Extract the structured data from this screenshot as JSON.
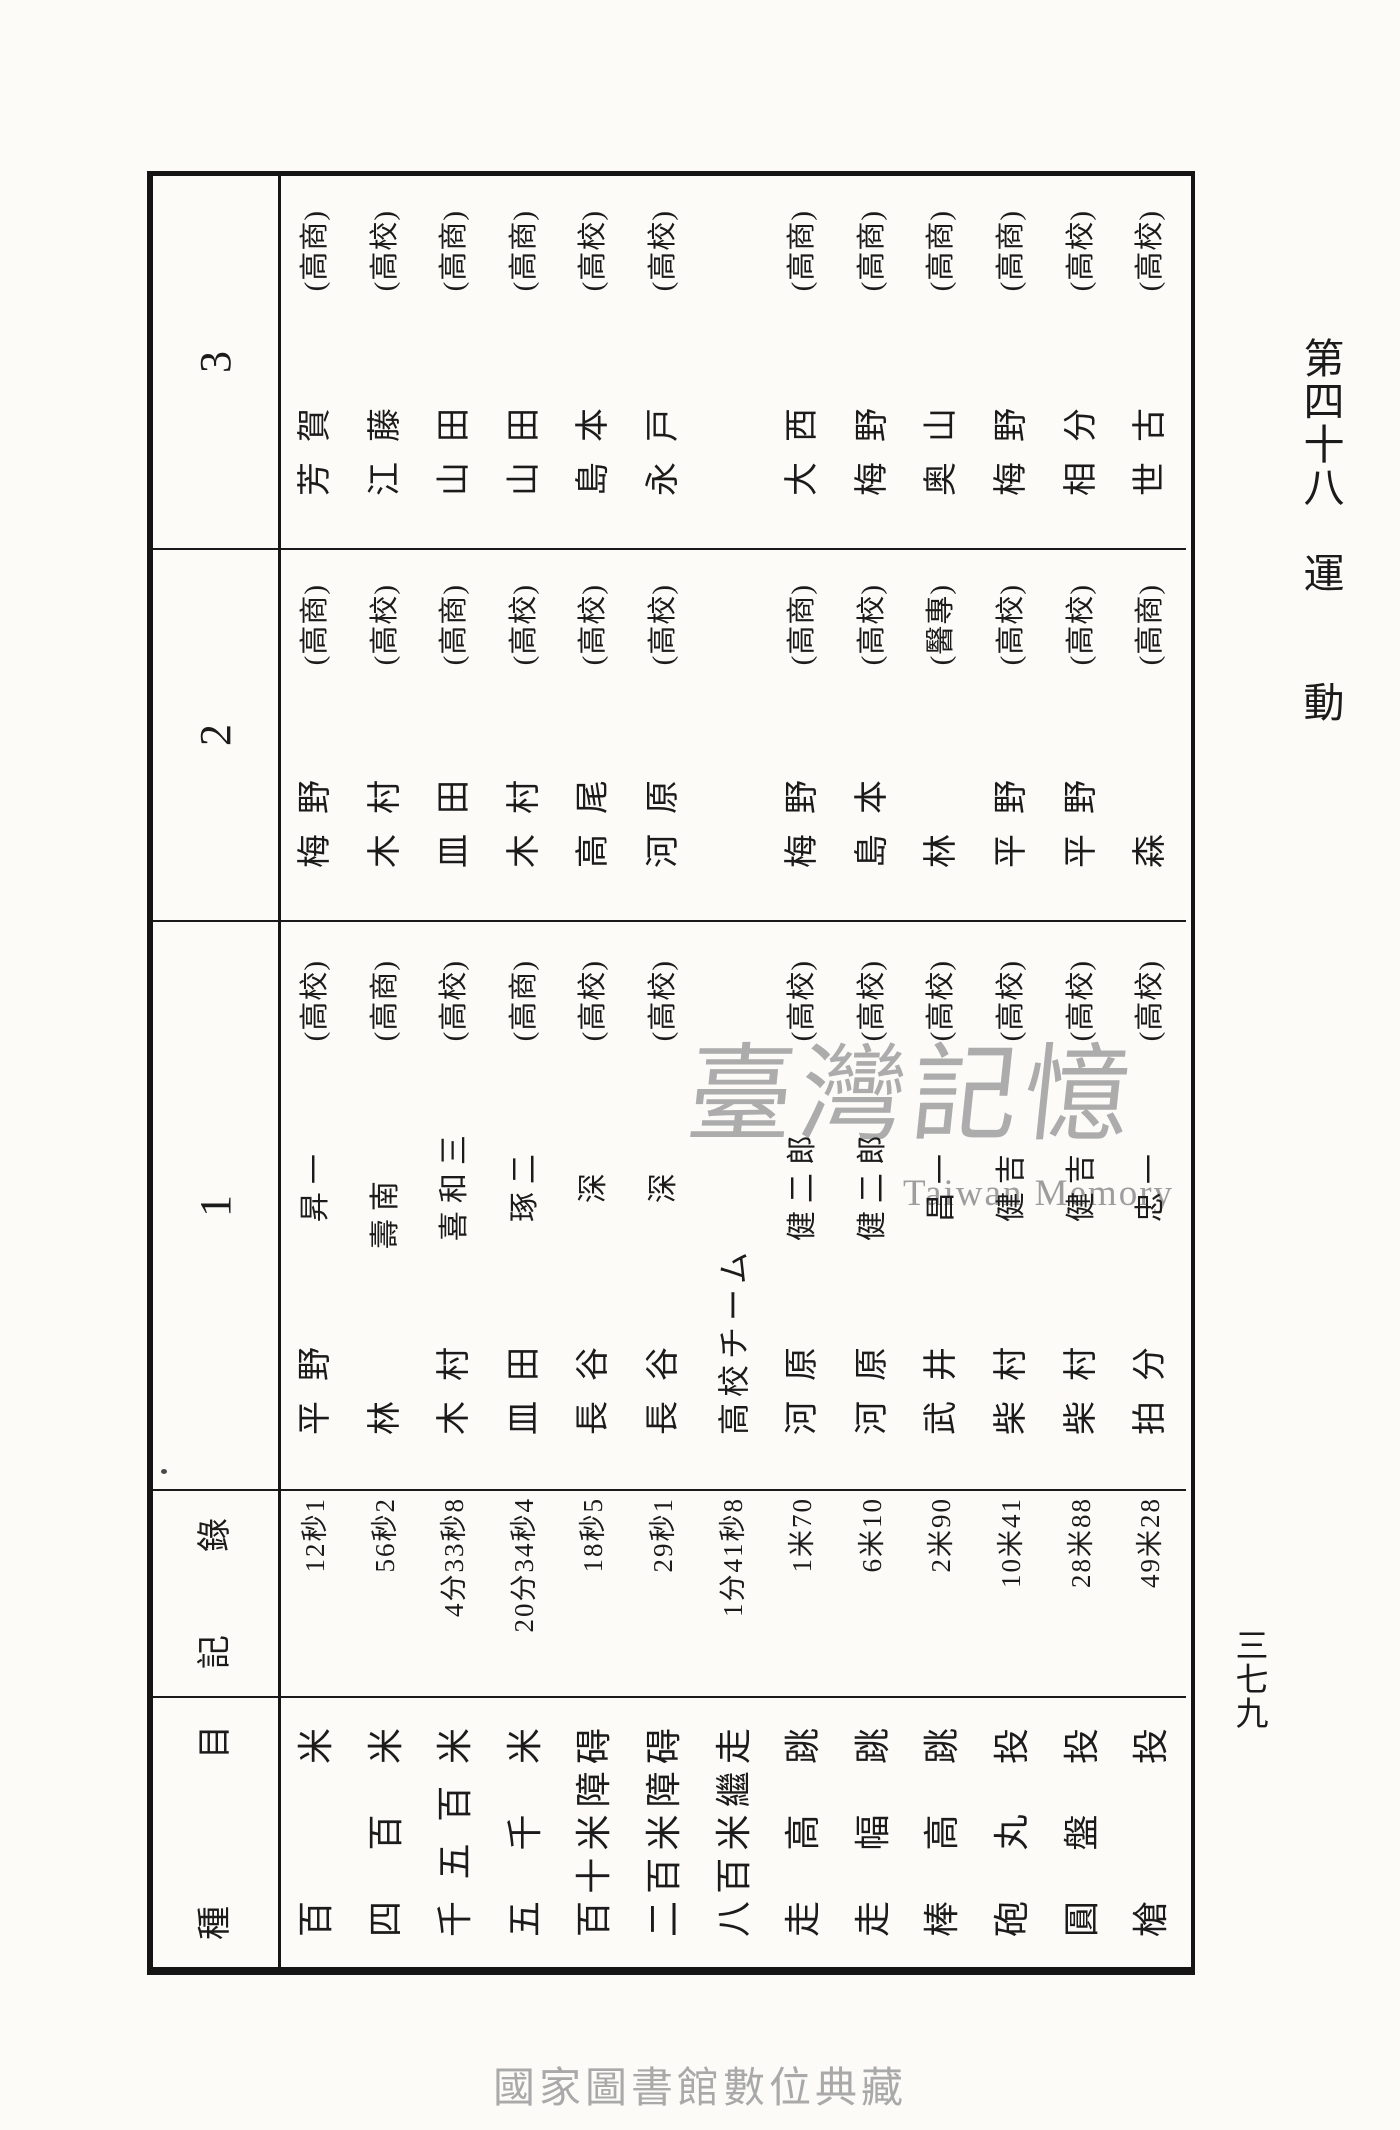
{
  "header": {
    "col_event": "種目",
    "col_record": "記錄",
    "col_1": "1",
    "col_2": "2",
    "col_3": "3"
  },
  "events": [
    {
      "event": "百米",
      "record": "12秒1",
      "first": {
        "surname": "平野",
        "given": "昇一",
        "school": "(高校)"
      },
      "second": {
        "surname": "梅野",
        "school": "(高商)"
      },
      "third": {
        "surname": "芳賀",
        "school": "(高商)"
      }
    },
    {
      "event": "四百米",
      "record": "56秒2",
      "first": {
        "surname": "林",
        "given": "壽南",
        "school": "(高商)"
      },
      "second": {
        "surname": "木村",
        "school": "(高校)"
      },
      "third": {
        "surname": "江藤",
        "school": "(高校)"
      }
    },
    {
      "event": "千五百米",
      "record": "4分33秒8",
      "first": {
        "surname": "木村",
        "given": "喜和三",
        "school": "(高校)"
      },
      "second": {
        "surname": "皿田",
        "school": "(高商)"
      },
      "third": {
        "surname": "山田",
        "school": "(高商)"
      }
    },
    {
      "event": "五千米",
      "record": "20分34秒4",
      "first": {
        "surname": "皿田",
        "given": "琢二",
        "school": "(高商)"
      },
      "second": {
        "surname": "木村",
        "school": "(高校)"
      },
      "third": {
        "surname": "山田",
        "school": "(高商)"
      }
    },
    {
      "event": "百十米障碍",
      "record": "18秒5",
      "first": {
        "surname": "長谷",
        "given": "深",
        "school": "(高校)"
      },
      "second": {
        "surname": "高尾",
        "school": "(高校)"
      },
      "third": {
        "surname": "島本",
        "school": "(高校)"
      }
    },
    {
      "event": "二百米障碍",
      "record": "29秒1",
      "first": {
        "surname": "長谷",
        "given": "深",
        "school": "(高校)"
      },
      "second": {
        "surname": "河原",
        "school": "(高校)"
      },
      "third": {
        "surname": "永戸",
        "school": "(高校)"
      }
    },
    {
      "event": "八百米繼走",
      "record": "1分41秒8",
      "first": {
        "team": "高校チーム"
      }
    },
    {
      "event": "走高跳",
      "record": "1米70",
      "first": {
        "surname": "河原",
        "given": "健二郎",
        "school": "(高校)"
      },
      "second": {
        "surname": "梅野",
        "school": "(高商)"
      },
      "third": {
        "surname": "大西",
        "school": "(高商)"
      }
    },
    {
      "event": "走幅跳",
      "record": "6米10",
      "first": {
        "surname": "河原",
        "given": "健二郎",
        "school": "(高校)"
      },
      "second": {
        "surname": "島本",
        "school": "(高校)"
      },
      "third": {
        "surname": "梅野",
        "school": "(高商)"
      }
    },
    {
      "event": "棒高跳",
      "record": "2米90",
      "first": {
        "surname": "武井",
        "given": "昌一",
        "school": "(高校)"
      },
      "second": {
        "surname": "林",
        "school": "(醫專)"
      },
      "third": {
        "surname": "奥山",
        "school": "(高商)"
      }
    },
    {
      "event": "砲丸投",
      "record": "10米41",
      "first": {
        "surname": "柴村",
        "given": "健吉",
        "school": "(高校)"
      },
      "second": {
        "surname": "平野",
        "school": "(高校)"
      },
      "third": {
        "surname": "梅野",
        "school": "(高商)"
      }
    },
    {
      "event": "圓盤投",
      "record": "28米88",
      "first": {
        "surname": "柴村",
        "given": "健吉",
        "school": "(高校)"
      },
      "second": {
        "surname": "平野",
        "school": "(高校)"
      },
      "third": {
        "surname": "相分",
        "school": "(高校)"
      }
    },
    {
      "event": "槍投",
      "record": "49米28",
      "first": {
        "surname": "拍分",
        "given": "忠一",
        "school": "(高校)"
      },
      "second": {
        "surname": "森",
        "school": "(高商)"
      },
      "third": {
        "surname": "世古",
        "school": "(高校)"
      }
    }
  ],
  "margin": {
    "chapter": "第四十八　運　　動",
    "page_number": "三七九"
  },
  "watermark": {
    "cjk": "臺灣記憶",
    "latin": "Taiwan Memory"
  },
  "footer": {
    "caption": "國家圖書館數位典藏"
  },
  "colors": {
    "ink": "#1b1b1b",
    "paper": "#fcfbf8",
    "watermark": "#a6a6a6",
    "caption": "#a9a9a9"
  }
}
